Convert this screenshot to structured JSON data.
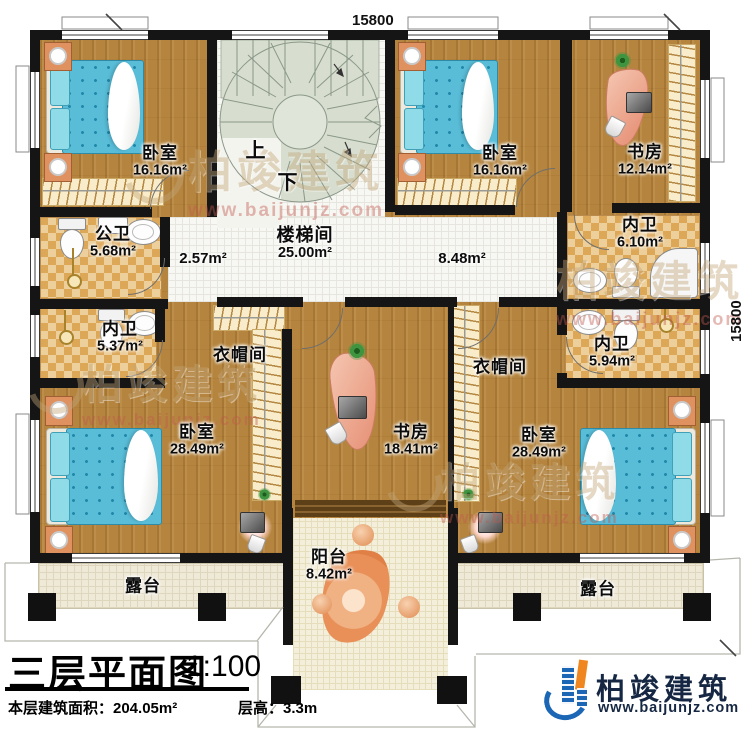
{
  "dimensions": {
    "top": "15800",
    "right": "15800"
  },
  "stair": {
    "up": "上",
    "down": "下"
  },
  "rooms": {
    "bedroom_tl": {
      "label": "卧室",
      "area": "16.16m²"
    },
    "bedroom_tr": {
      "label": "卧室",
      "area": "16.16m²"
    },
    "study_tr": {
      "label": "书房",
      "area": "12.14m²"
    },
    "bath_inner_tr": {
      "label": "内卫",
      "area": "6.10m²"
    },
    "bath_public": {
      "label": "公卫",
      "area": "5.68m²"
    },
    "stairwell": {
      "label": "楼梯间",
      "area": "25.00m²"
    },
    "corridor_left": {
      "area": "2.57m²"
    },
    "corridor_right": {
      "area": "8.48m²"
    },
    "bath_inner_l": {
      "label": "内卫",
      "area": "5.37m²"
    },
    "bath_inner_r": {
      "label": "内卫",
      "area": "5.94m²"
    },
    "closet_left": {
      "label": "衣帽间"
    },
    "closet_right": {
      "label": "衣帽间"
    },
    "bedroom_bl": {
      "label": "卧室",
      "area": "28.49m²"
    },
    "study_center": {
      "label": "书房",
      "area": "18.41m²"
    },
    "bedroom_br": {
      "label": "卧室",
      "area": "28.49m²"
    },
    "terrace_left": {
      "label": "露台"
    },
    "terrace_right": {
      "label": "露台"
    },
    "balcony": {
      "label": "阳台",
      "area": "8.42m²"
    }
  },
  "title_block": {
    "title": "三层平面图",
    "scale": "1:100",
    "area_label": "本层建筑面积：204.05m²",
    "height_label": "层高：3.3m"
  },
  "watermark": {
    "name": "柏竣建筑",
    "url": "www.baijunjz.com"
  },
  "logo": {
    "name": "柏竣建筑",
    "url": "www.baijunjz.com"
  },
  "colors": {
    "wood": "#b5853f",
    "wall": "#151515",
    "checker": "#dda758",
    "stair": "#d7decf",
    "bed": "#59bdd8",
    "desk": "#e58d72",
    "logo_blue": "#1b66b5",
    "logo_orange": "#f0861f"
  }
}
